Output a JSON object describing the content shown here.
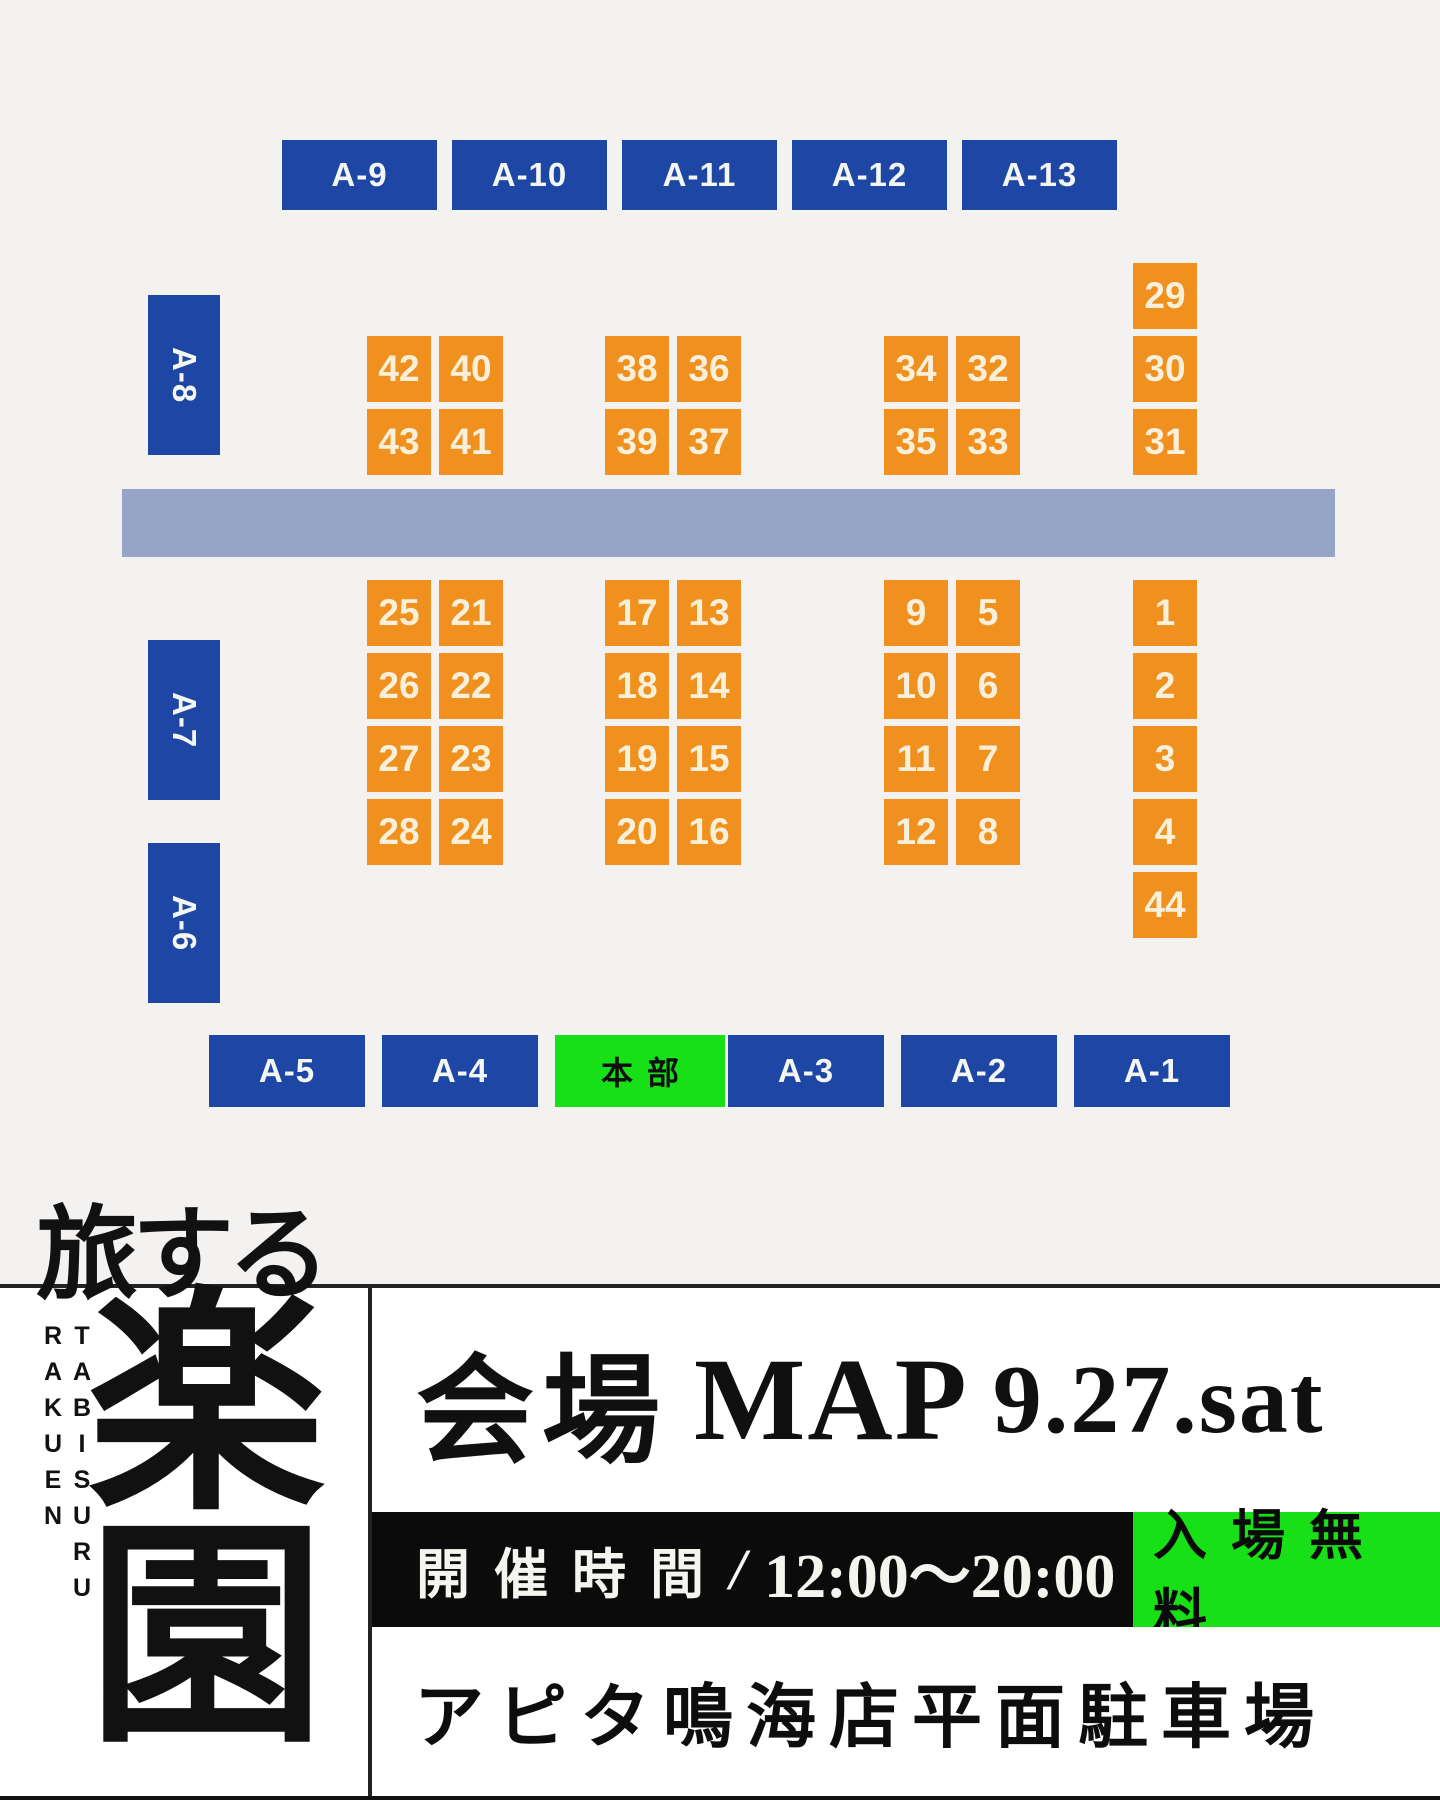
{
  "map": {
    "colors": {
      "background": "#f3f2f0",
      "road": "#95a4c7",
      "booth_blue": "#1e46a4",
      "stall_orange": "#f0911f",
      "hq_green": "#17e017"
    },
    "hq_label": "本部",
    "top_booths": [
      "A-9",
      "A-10",
      "A-11",
      "A-12",
      "A-13"
    ],
    "left_booths": [
      "A-8",
      "A-7",
      "A-6"
    ],
    "bottom_booths": [
      "A-5",
      "A-4",
      "本部",
      "A-3",
      "A-2",
      "A-1"
    ],
    "stalls_above_road": [
      "42",
      "40",
      "43",
      "41",
      "38",
      "36",
      "39",
      "37",
      "34",
      "32",
      "35",
      "33",
      "29",
      "30",
      "31"
    ],
    "stalls_below_road": [
      "25",
      "21",
      "26",
      "22",
      "27",
      "23",
      "28",
      "24",
      "17",
      "13",
      "18",
      "14",
      "19",
      "15",
      "20",
      "16",
      "9",
      "5",
      "10",
      "6",
      "11",
      "7",
      "12",
      "8",
      "1",
      "2",
      "3",
      "4",
      "44"
    ]
  },
  "footer": {
    "logo": {
      "title_kana": "旅する",
      "title_kanji": "楽園",
      "romaji": "TABISURU RAKUEN"
    },
    "heading": {
      "venue_label": "会場",
      "map_label": "MAP",
      "date": "9.27.sat"
    },
    "hours": {
      "label": "開催時間",
      "separator": "/",
      "value": "12:00〜20:00"
    },
    "admission": {
      "label": "入場無料"
    },
    "venue_name": "アピタ鳴海店平面駐車場"
  }
}
